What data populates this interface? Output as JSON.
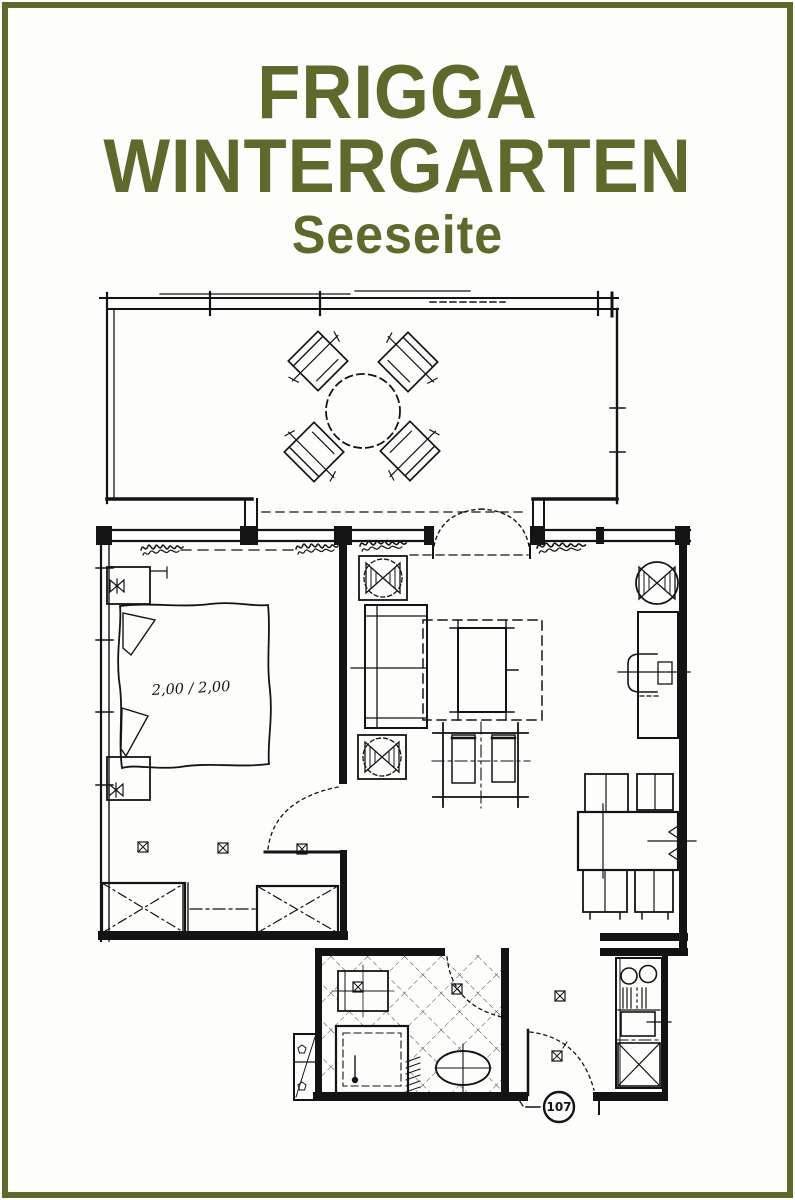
{
  "colors": {
    "accent_green": "#5e692c",
    "ink": "#141414",
    "paper": "#fdfdfb"
  },
  "header": {
    "line1": "FRIGGA",
    "line2": "WINTERGARTEN",
    "subtitle": "Seeseite"
  },
  "floor_plan": {
    "bed_label": "2,00 / 2,00",
    "unit_number": "107",
    "symbols": [
      "round-table-icon",
      "patio-chair-icon",
      "french-door-icon",
      "double-bed-icon",
      "nightstand-icon",
      "lamp-icon",
      "wardrobe-icon",
      "sofa-icon",
      "armchair-icon",
      "coffee-table-icon",
      "side-table-icon",
      "dining-table-icon",
      "dining-chair-icon",
      "desk-icon",
      "shower-icon",
      "washbasin-icon",
      "kitchenette-icon",
      "stove-icon",
      "sink-icon",
      "entrance-door-icon",
      "outlet-icon",
      "dimension-scribble-icon"
    ]
  }
}
